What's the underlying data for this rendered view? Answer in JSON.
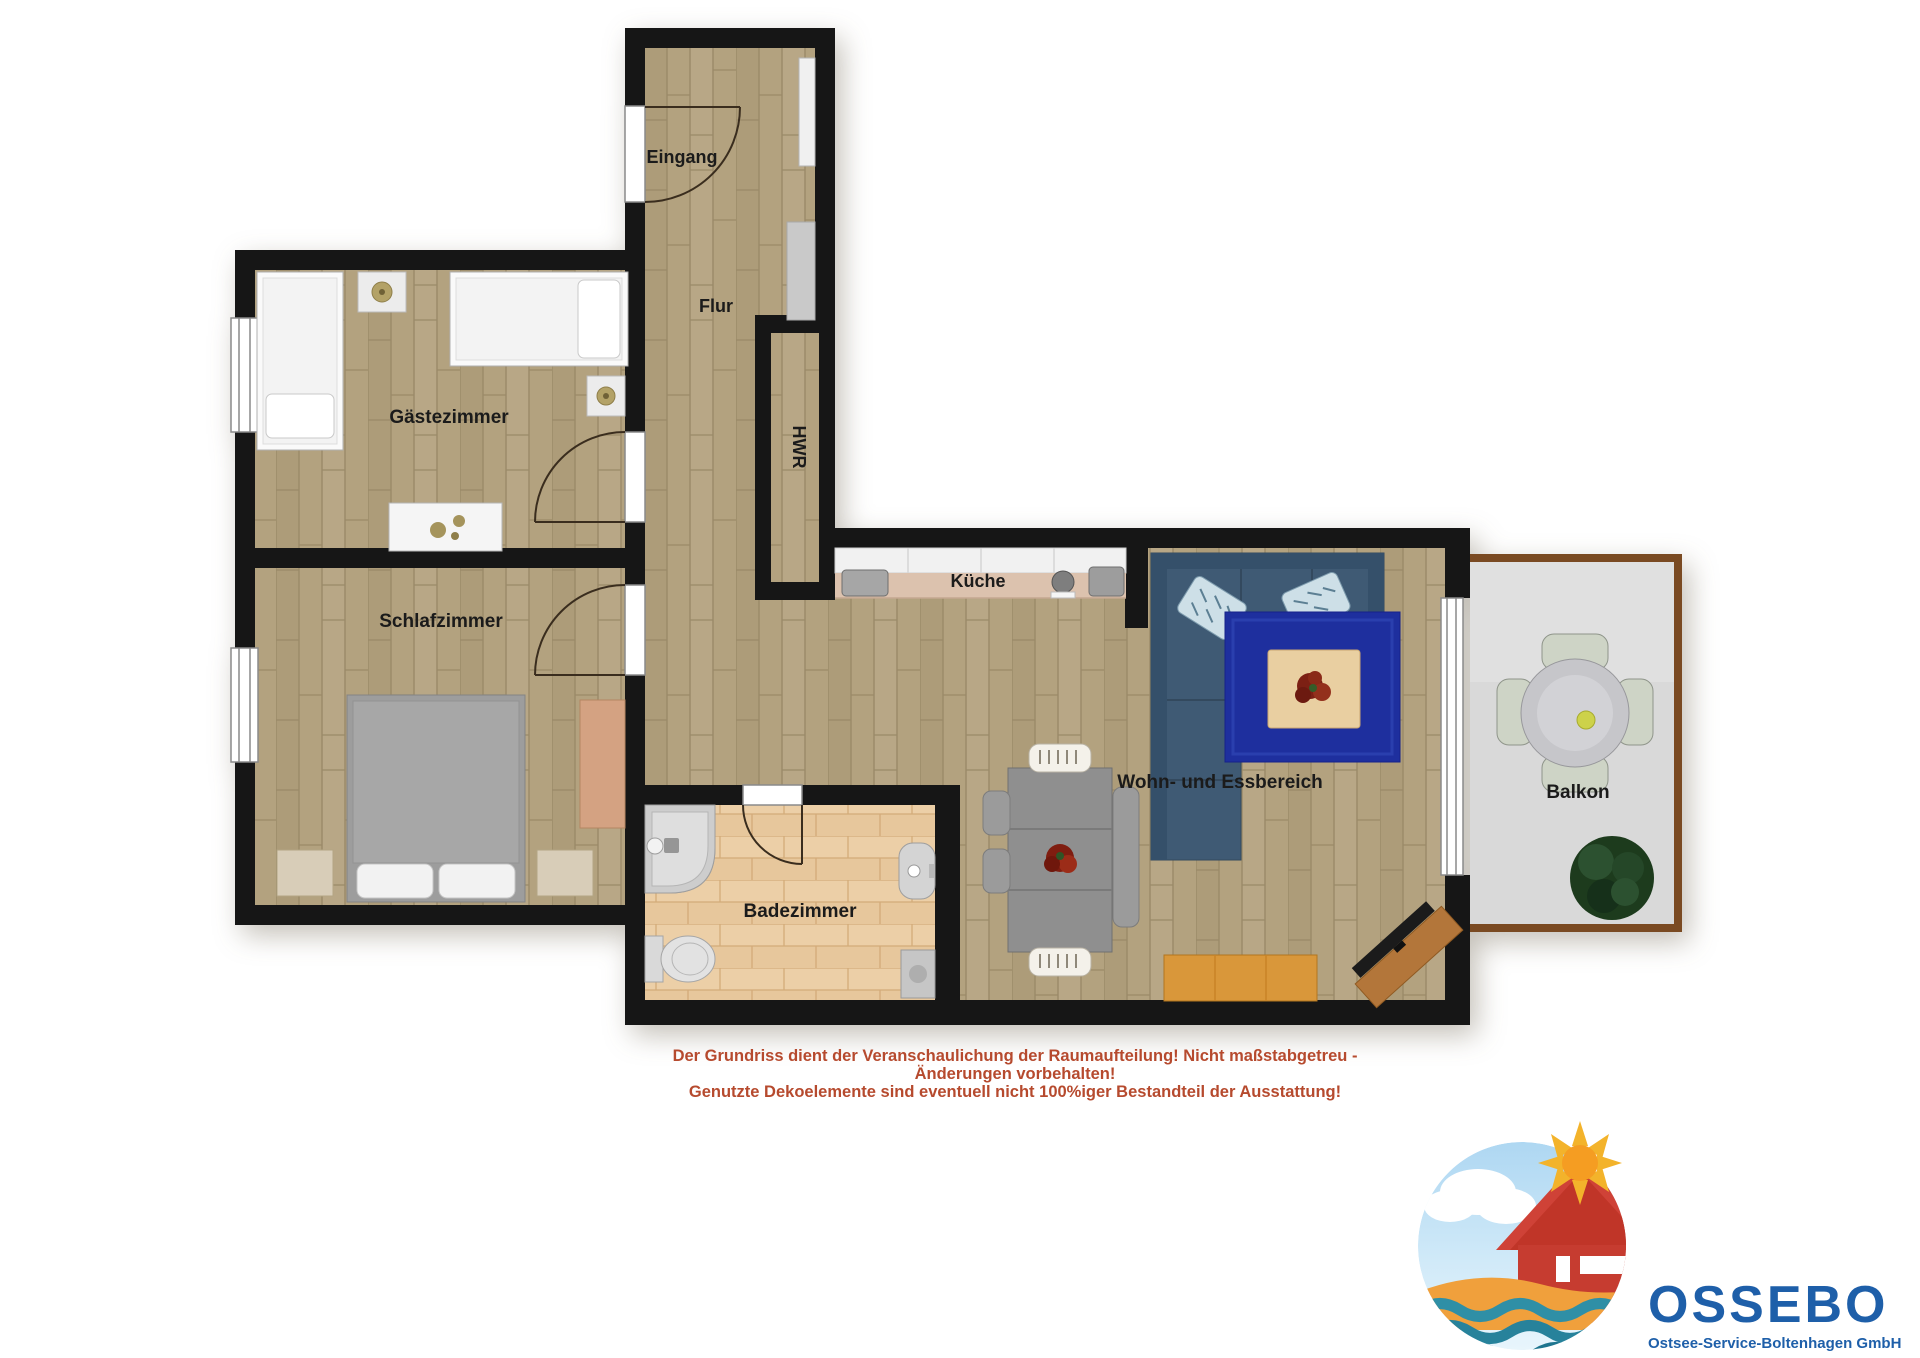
{
  "rooms": {
    "eingang": "Eingang",
    "flur": "Flur",
    "hwr": "HWR",
    "gaestezimmer": "Gästezimmer",
    "schlafzimmer": "Schlafzimmer",
    "kueche": "Küche",
    "badezimmer": "Badezimmer",
    "wohn_essbereich": "Wohn- und Essbereich",
    "balkon": "Balkon"
  },
  "disclaimer": {
    "line1": "Der Grundriss dient der Veranschaulichung der Raumaufteilung! Nicht maßstabgetreu -",
    "line2": "Änderungen vorbehalten!",
    "line3": "Genutzte Dekoelemente sind eventuell nicht 100%iger Bestandteil der Ausstattung!",
    "color": "#b64a2e"
  },
  "logo": {
    "company": "OSSEBO",
    "subtitle": "Ostsee-Service-Boltenhagen GmbH",
    "color": "#1e5fa9"
  },
  "colors": {
    "wall": "#161616",
    "wood_floor": "#b3a27f",
    "bathroom_tile": "#eccfa7",
    "balcony_floor": "#d9d9d9",
    "balcony_frame": "#7a4a22",
    "sofa_blue": "#3f5a74",
    "rug_blue": "#1e2f9e",
    "sideboard_wood": "#d9973a",
    "logo_red_house": "#cf4237",
    "logo_sun": "#f3a52b",
    "logo_water": "#2f8fa6"
  }
}
